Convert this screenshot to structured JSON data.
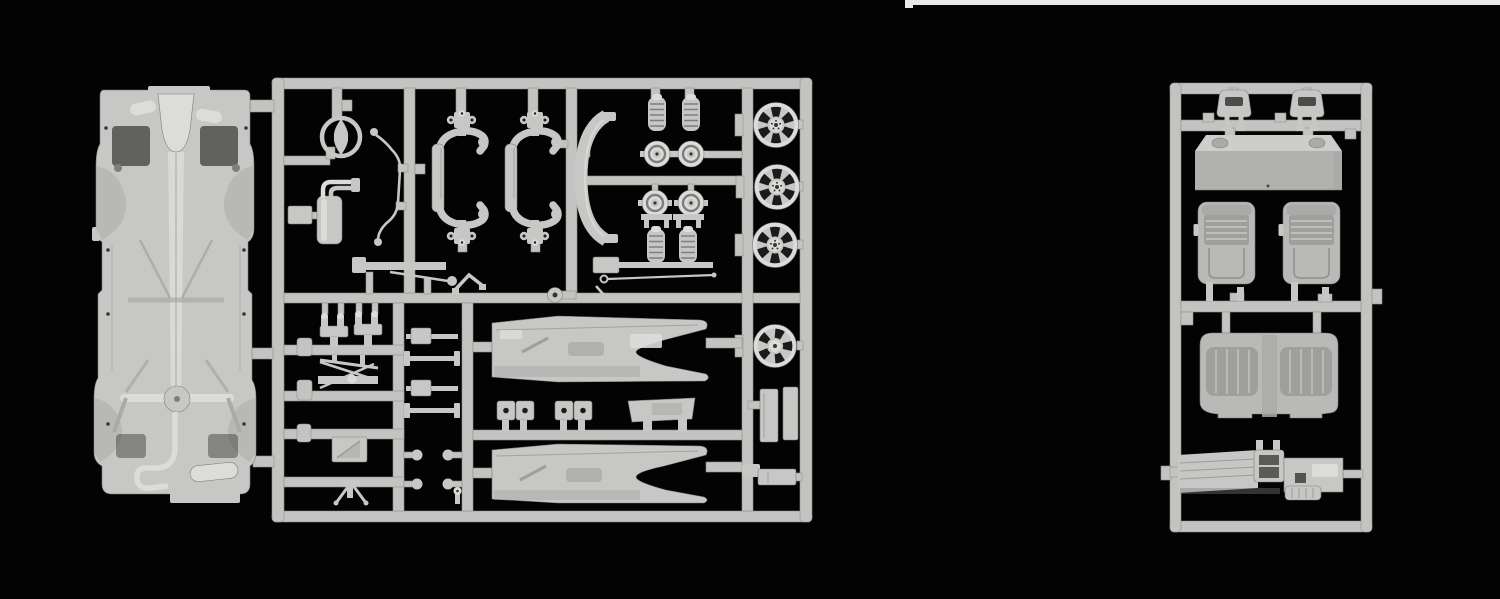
{
  "scene": {
    "type": "product-photo",
    "subject": "plastic scale-model car kit sprues",
    "description": "Two light-gray injection-molded sprue frames of an unassembled model car kit photographed on a solid black background. The large left sprue holds the chassis floor pan, steering wheel, exhaust, suspension, wheels and body panels; the smaller right sprue holds interior parts: headrests, parcel shelf, bucket seats, rear bench seat and dashboard console.",
    "photo_strip": "thin light strip along the top-right edge of the photograph"
  },
  "palette": {
    "background": "#030303",
    "photo_strip": "#e9e9e7",
    "runner": "#c3c3c1",
    "runner_dark": "#8f8f8d",
    "part": "#c7c7c5",
    "part_light": "#dcdcda",
    "part_mid": "#aaaaa8",
    "part_dark": "#7e7e7c",
    "recess": "#363634",
    "hole": "#1b1b1b",
    "seat": "#b9b9b7",
    "seat_dark": "#9f9f9d",
    "box_top": "#cdcdcb",
    "box_front": "#b1b1af"
  },
  "sprues": {
    "left": {
      "name": "sprue-a-chassis-and-running-gear",
      "parts": [
        "chassis floor pan",
        "steering wheel",
        "exhaust muffler with twin pipes",
        "brake line harness",
        "axle yoke frame x2",
        "rear window surround",
        "coil spring x4",
        "brake drum hub x4",
        "leaf spring bar",
        "axle bar",
        "anti-roll bar",
        "idler pulley",
        "control arm pair",
        "steering linkage",
        "tie rod",
        "battery box",
        "jack stand",
        "drive shaft rod pair x2",
        "mounting peg x4",
        "bolt peg",
        "seat cushion pair x2",
        "tail panel",
        "rocker panel x2",
        "road wheel x4",
        "mounting plate x2",
        "sill bar"
      ]
    },
    "right": {
      "name": "sprue-b-interior",
      "parts": [
        "headrest x2",
        "rear parcel shelf",
        "bucket seat x2",
        "rear bench seat",
        "dashboard with centre console",
        "mounting pegs and tabs"
      ]
    }
  }
}
